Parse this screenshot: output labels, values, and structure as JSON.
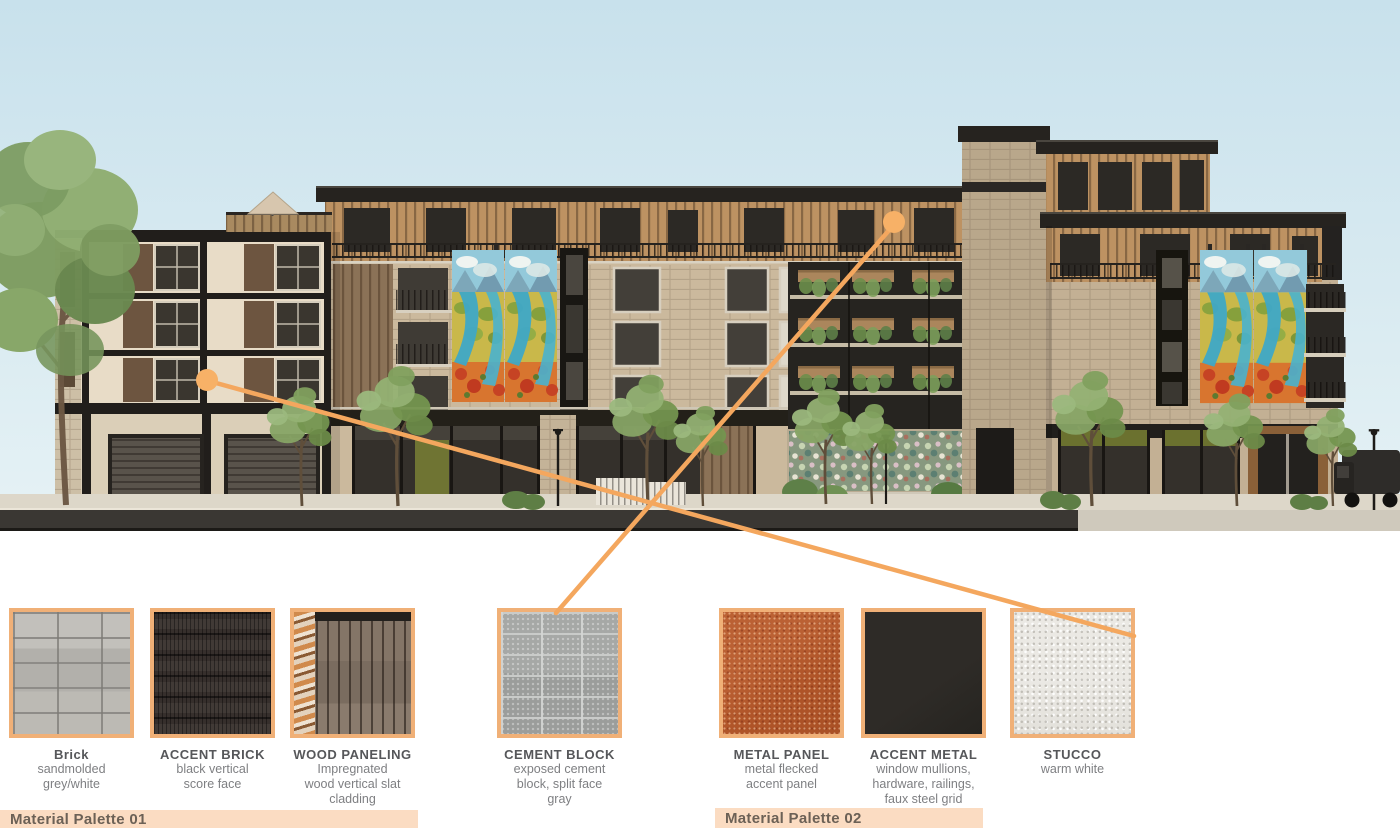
{
  "scene": {
    "description": "Street-facing architectural elevation rendering of a 4-5 story mixed-use building with brick, wood slat and mural facades, rooftop terrace, street trees and storefronts",
    "sky_color": "#cde4ed",
    "leader_line_color": "#f4a75e",
    "callouts": [
      {
        "dot_on": "left building stucco wall",
        "points_to": "STUCCO"
      },
      {
        "dot_on": "upper wood clad floor near courtyard",
        "points_to": "CEMENT BLOCK"
      }
    ]
  },
  "materials": [
    {
      "name": "Brick",
      "desc": "sandmolded\ngrey/white",
      "texture": "brick-grey"
    },
    {
      "name": "ACCENT BRICK",
      "desc": "black vertical\nscore face",
      "texture": "accent-brick"
    },
    {
      "name": "WOOD PANELING",
      "desc": "Impregnated\nwood vertical slat\ncladding",
      "texture": "wood-slat"
    },
    {
      "name": "CEMENT BLOCK",
      "desc": "exposed cement\nblock, split face\ngray",
      "texture": "cement-block"
    },
    {
      "name": "METAL PANEL",
      "desc": "metal flecked\naccent panel",
      "texture": "metal-panel"
    },
    {
      "name": "ACCENT METAL",
      "desc": "window mullions,\nhardware, railings,\nfaux steel grid",
      "texture": "accent-metal"
    },
    {
      "name": "STUCCO",
      "desc": "warm white",
      "texture": "stucco"
    }
  ],
  "palettes": [
    {
      "label": "Material Palette 01"
    },
    {
      "label": "Material Palette 02"
    }
  ],
  "colors": {
    "swatch_border": "#f0b077",
    "bar_background": "#fbdcc2",
    "bar_text": "#6c6156",
    "material_name": "#56575a",
    "material_desc": "#7e7f82"
  }
}
